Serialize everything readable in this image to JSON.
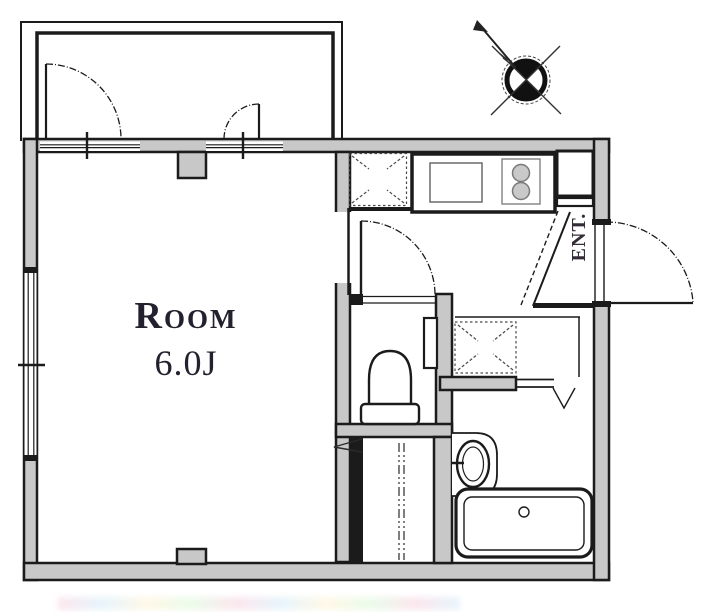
{
  "title": "Apartment floor plan",
  "room": {
    "label": "Room",
    "size": "6.0J"
  },
  "entrance": {
    "label": "ENT."
  },
  "icons": {
    "compass": "north-arrow-compass-icon",
    "kitchen_sink": "sink-icon",
    "stove": "two-burner-stove-icon",
    "refrigerator_space": "dashed-square-x-icon",
    "washing_machine_space": "dashed-square-x-icon",
    "toilet": "toilet-icon",
    "washbasin": "washbasin-icon",
    "bathtub": "bathtub-icon"
  },
  "colors": {
    "wall_fill": "#c8c8c8",
    "wall_line": "#1b1b1b",
    "label_text": "#23212e",
    "entrance_text": "#342d38"
  }
}
